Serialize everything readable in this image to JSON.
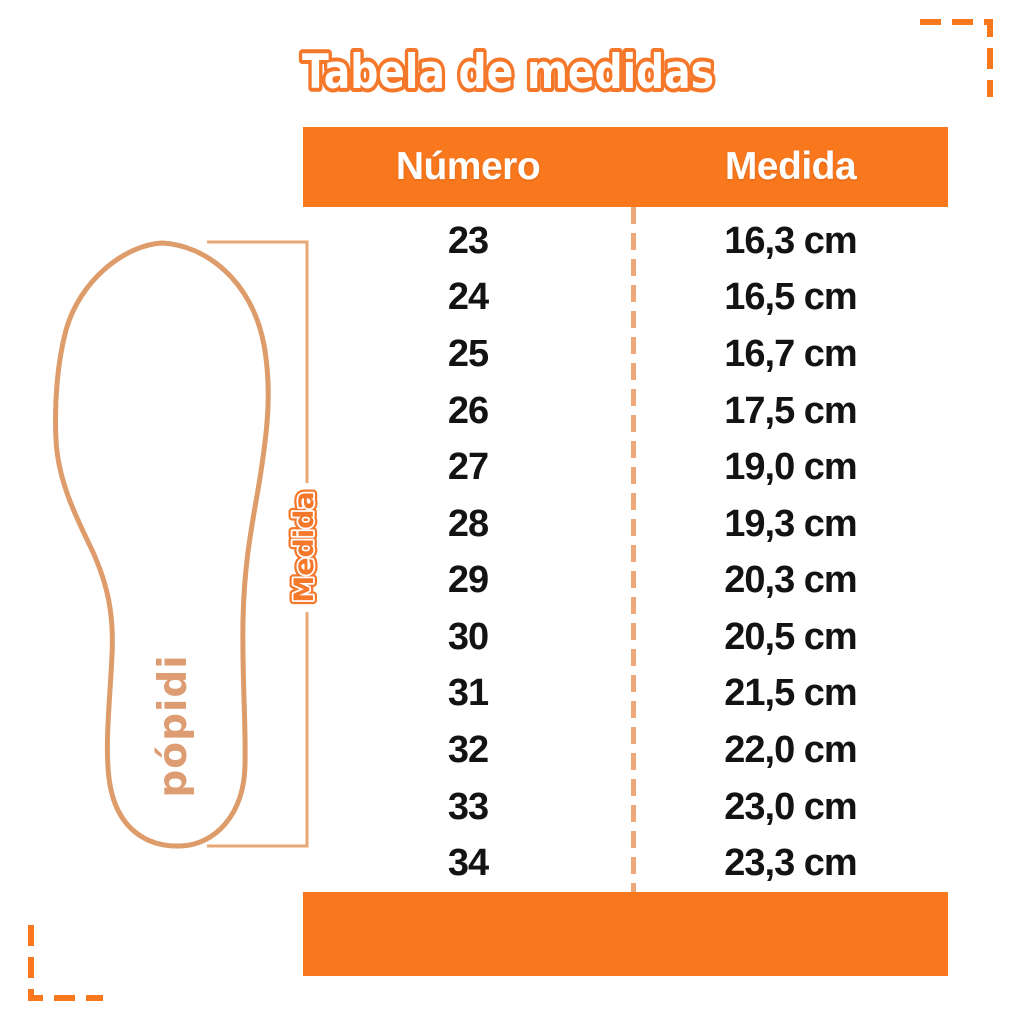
{
  "title": "Tabela de medidas",
  "chart_data": {
    "type": "table",
    "title": "Tabela de medidas",
    "columns": [
      "Número",
      "Medida"
    ],
    "rows": [
      [
        "23",
        "16,3 cm"
      ],
      [
        "24",
        "16,5 cm"
      ],
      [
        "25",
        "16,7 cm"
      ],
      [
        "26",
        "17,5 cm"
      ],
      [
        "27",
        "19,0 cm"
      ],
      [
        "28",
        "19,3 cm"
      ],
      [
        "29",
        "20,3 cm"
      ],
      [
        "30",
        "20,5 cm"
      ],
      [
        "31",
        "21,5 cm"
      ],
      [
        "32",
        "22,0 cm"
      ],
      [
        "33",
        "23,0 cm"
      ],
      [
        "34",
        "23,3 cm"
      ]
    ],
    "layout_hints": {
      "header_background": "orange solid bar",
      "footer_background": "orange solid bar",
      "column_divider": "vertical dashed light-orange line"
    }
  },
  "diagram": {
    "measure_label": "Medida",
    "brand": "pópidi",
    "description": "insole outline with vertical measurement bracket"
  },
  "colors": {
    "orange": "#F9771D",
    "title_stroke": "#F4772A",
    "insole_stroke": "#DE9C6B",
    "bracket": "#E8A876",
    "divider_dash": "#EFA878",
    "brand_text": "#DD9C72",
    "row_text": "#131313"
  }
}
